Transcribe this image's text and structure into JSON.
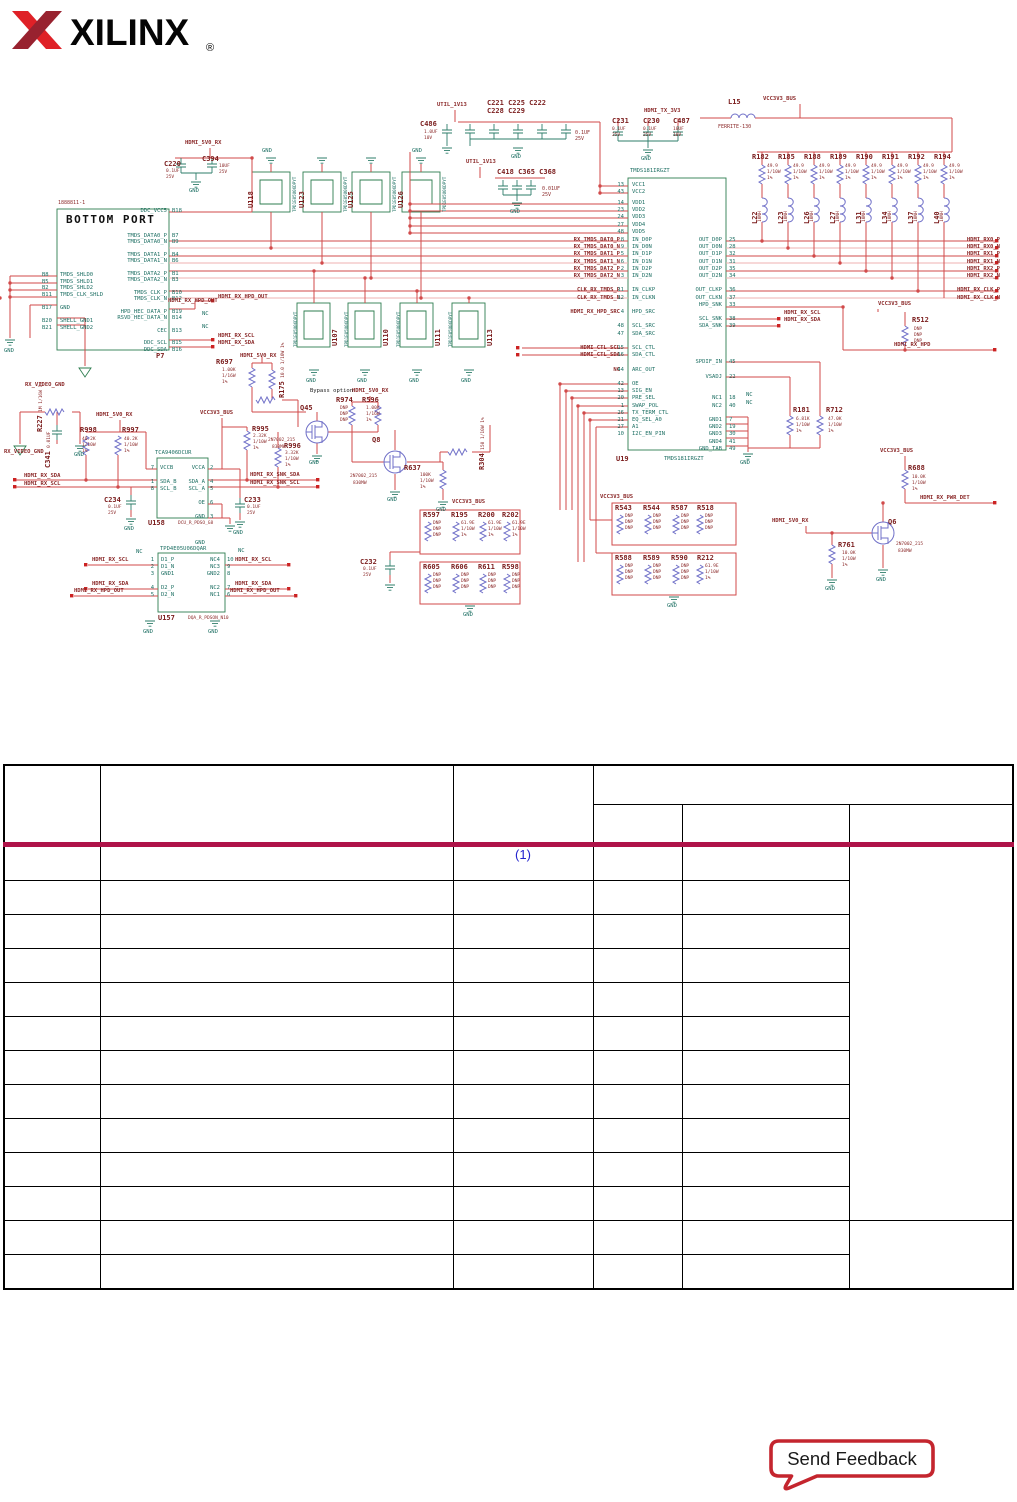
{
  "colors": {
    "crimson_rule": "#AF1349",
    "footnote_blue": "#2222CE",
    "feedback_red": "#C4252E",
    "logo_red_bright": "#DF2127",
    "logo_red_dark": "#98222F",
    "wire_red": "#D14A4A",
    "wire_pink": "#EFB2B2",
    "box_green": "#2E7D4F",
    "symbol_blue": "#7070C8",
    "text_maroon": "#8C2B2B",
    "pin_teal": "#1D6F63"
  },
  "logo": {
    "brand": "XILINX",
    "reg": "®"
  },
  "gnd": "GND",
  "nc": "NC",
  "nets": {
    "hdmi_5v0_rx": "HDMI_5V0_RX",
    "util_1v13": "UTIL_1V13",
    "hdmi_tx_3v3": "HDMI_TX_3V3",
    "vcc3v3_bus": "VCC3V3_BUS",
    "rx_video_gnd": "RX_VIDEO_GND",
    "hdmi_rx_scl": "HDMI_RX_SCL",
    "hdmi_rx_sda": "HDMI_RX_SDA",
    "hdmi_rx_hpd_out": "HDMI_RX_HPD_OUT",
    "hdmi_rx_hpd": "HDMI_RX_HPD",
    "hdmi_rx_pwr_det": "HDMI_RX_PWR_DET",
    "hdmi_rx_snk_sda": "HDMI_RX_SNK_SDA",
    "hdmi_rx_snk_scl": "HDMI_RX_SNK_SCL",
    "bypass_note": "Bypass option",
    "rx_pairs": "HDMI_RX0_P\nHDMI_RX0_N\nHDMI_RX1_P\nHDMI_RX1_N\nHDMI_RX2_P\nHDMI_RX2_N\n\nHDMI_RX_CLK_P\nHDMI_RX_CLK_N"
  },
  "p7": {
    "ref": "P7",
    "part": "1888811-1",
    "title": "BOTTOM PORT",
    "right_names": "DDC_VCC5\n\n\n\nTMDS_DATA0_P\nTMDS_DATA0_N\n\nTMDS_DATA1_P\nTMDS_DATA1_N\n\nTMDS_DATA2_P\nTMDS_DATA2_N\n\nTMDS_CLK_P\nTMDS_CLK_N\n\nHPD_HEC_DATA_P\nRSVD_HEC_DATA_N\n\nCEC\n\nDDC_SCL\nDDC_SDA",
    "right_pins": "B18\n\n\n\nB7\nB9\n\nB4\nB6\n\nB1\nB3\n\nB10\nB12\n\nB19\nB14\n\nB13\n\nB15\nB16",
    "left_pins": "B8\nB5\nB2\nB11\n\nB17\n\nB20\nB21",
    "left_names": "TMDS_SHLD0\nTMDS_SHLD1\nTMDS_SHLD2\nTMDS_CLK_SHLD\n\nGND\n\nSHELL_GND1\nSHELL_GND2"
  },
  "u19": {
    "ref": "U19",
    "part": "TMDS181IRGZT",
    "vcc_pins": "13\n43",
    "vcc_names": "VCC1\nVCC2",
    "vdd_pins": "14\n23\n24\n27\n48",
    "vdd_names": "VDD1\nVDD2\nVDD3\nVDD4\nVDD5",
    "left_nets": "RX_TMDS_DAT0_P\nRX_TMDS_DAT0_N\nRX_TMDS_DAT1_P\nRX_TMDS_DAT1_N\nRX_TMDS_DAT2_P\nRX_TMDS_DAT2_N\n\nCLK_RX_TMDS_P\nCLK_RX_TMDS_N\n\nHDMI_RX_HPD_SRC\n\n\n\n\nHDMI_CTL_SCL\nHDMI_CTL_SDA\n\nNC",
    "left_pins": "8\n9\n5\n6\n2\n3\n\n11\n12\n\n4\n\n48\n47\n\n15\n16\n\n44\n\n42\n13\n20\n1\n26\n21\n27\n10",
    "left_names": "IN_D0P\nIN_D0N\nIN_D1P\nIN_D1N\nIN_D2P\nIN_D2N\n\nIN_CLKP\nIN_CLKN\n\nHPD_SRC\n\nSCL_SRC\nSDA_SRC\n\nSCL_CTL\nSDA_CTL\n\nARC_OUT\n\nOE\nSIG_EN\nPRE_SEL\nSWAP_POL\nTX_TERM_CTL\nEQ_SEL_A0\nA1\nI2C_EN_PIN",
    "right_names": "OUT_D0P\nOUT_D0N\nOUT_D1P\nOUT_D1N\nOUT_D2P\nOUT_D2N\n\nOUT_CLKP\nOUT_CLKN\nHPD_SNK\n\nSCL_SNK\nSDA_SNK\n\n\n\n\nSPDIF_IN\n\nVSADJ\n\n\nNC1\nNC2\n\nGND1\nGND2\nGND3\nGND4\nGND_TAB",
    "right_pins": "25\n28\n32\n31\n35\n34\n\n36\n37\n33\n\n38\n39\n\n\n\n\n45\n\n22\n\n\n18\n40\n\n7\n19\n30\n41\n49"
  },
  "u158": {
    "ref": "U158",
    "part": "TCA9406DCUR",
    "pkg": "DCU_R_PDSO_G8",
    "left_pins": "7\n\n1\n8",
    "left_names": "VCCB\n\nSDA_B\nSCL_B",
    "right_names": "VCCA\n\nSDA_A\nSCL_A\n\nOE\n\nGND",
    "right_pins": "2\n\n4\n5\n\n6\n\n3"
  },
  "u157": {
    "ref": "U157",
    "part": "TPD4E05U06DQAR",
    "pkg": "DQA_R_PDSON_N10",
    "l_pins_a": "1\n2\n3",
    "l_names_a": "D1_P\nD1_N\nGND1",
    "l_pins_b": "4\n5",
    "l_names_b": "D2_P\nD2_N",
    "r_names_a": "NC4\nNC3\nGND2",
    "r_pins_a": "10\n9\n8",
    "r_names_b": "NC2\nNC1",
    "r_pins_b": "7\n6"
  },
  "tvs": {
    "part": "TPD1E05U06DPYT",
    "top_refs": [
      "U118",
      "U123",
      "U125",
      "U126"
    ],
    "mid_refs": [
      "U107",
      "U110",
      "U111",
      "U113"
    ]
  },
  "bank": {
    "r_refs": [
      "R182",
      "R185",
      "R188",
      "R189",
      "R190",
      "R191",
      "R192",
      "R194"
    ],
    "r_val": "49.9\n1/10W\n1%",
    "l_refs": [
      "L22",
      "L23",
      "L26",
      "L27",
      "L31",
      "L34",
      "L37",
      "L40"
    ],
    "l_val": "10NH"
  },
  "ind": {
    "l15": "L15",
    "l15_part": "FERRITE-130"
  },
  "caps": {
    "c220": "C220",
    "c220_v": "0.1UF\n25V",
    "c394": "C394",
    "c394_v": "10UF\n25V",
    "grp1": "C221 C225 C222\nC228 C229",
    "grp1_v": "0.1UF\n25V",
    "c486": "C486",
    "c486_v": "1.0UF\n10V",
    "grp2": "C418 C365 C368",
    "grp2_v": "0.01UF\n25V",
    "c231": "C231",
    "c231_v": "0.1UF\n25V",
    "c230": "C230",
    "c230_v": "0.1UF\n25V",
    "c487": "C487",
    "c487_v": "10UF\n10V",
    "c341": "C341",
    "c341_v": "0.01UF",
    "c234": "C234",
    "c234_v": "0.1UF\n25V",
    "c233": "C233",
    "c233_v": "0.1UF\n25V",
    "c232": "C232",
    "c232_v": "0.1UF\n25V"
  },
  "res": {
    "r697": "R697",
    "r697_v": "1.00K\n1/16W\n1%",
    "r175": "R175",
    "r175_v": "10.0 1/10W 1%",
    "r227": "R227",
    "r227_v": "1M 1/16W 1%",
    "r974": "R974",
    "r596": "R596",
    "r596_v": "1.00K\n1/16W\n1%",
    "r637": "R637",
    "r637_v": "100K\n1/10W\n1%",
    "r304": "R304",
    "r304_v": "150 1/10W 1%",
    "r998": "R998",
    "r997": "R997",
    "r40_v": "40.2K\n1/10W\n1%",
    "r995": "R995",
    "r995_v": "2.32K\n1/10W\n1%",
    "r996": "R996",
    "r996_v": "3.32K\n1/10W\n1%",
    "dnp": "DNP\nDNP\nDNP",
    "r61_v": "61.9E\n1/10W\n1%",
    "g1": [
      "R597",
      "R195",
      "R200",
      "R202"
    ],
    "g2": [
      "R605",
      "R606",
      "R611",
      "R598"
    ],
    "g3": [
      "R543",
      "R544",
      "R587",
      "R518"
    ],
    "g4": [
      "R588",
      "R589",
      "R590",
      "R212"
    ],
    "r512": "R512",
    "r181": "R181",
    "r181_v": "6.81K\n1/10W\n1%",
    "r712": "R712",
    "r712_v": "47.0K\n1/10W\n1%",
    "r688": "R688",
    "r688_v": "10.0K\n1/10W\n1%",
    "r761": "R761",
    "r761_v": "10.0K\n1/10W\n1%"
  },
  "fets": {
    "q45": "Q45",
    "q8": "Q8",
    "q6": "Q6",
    "part": "2N7002_215",
    "rating": "830MW"
  },
  "table": {
    "footnote_marker": "(1)"
  },
  "feedback": {
    "label": "Send Feedback"
  }
}
